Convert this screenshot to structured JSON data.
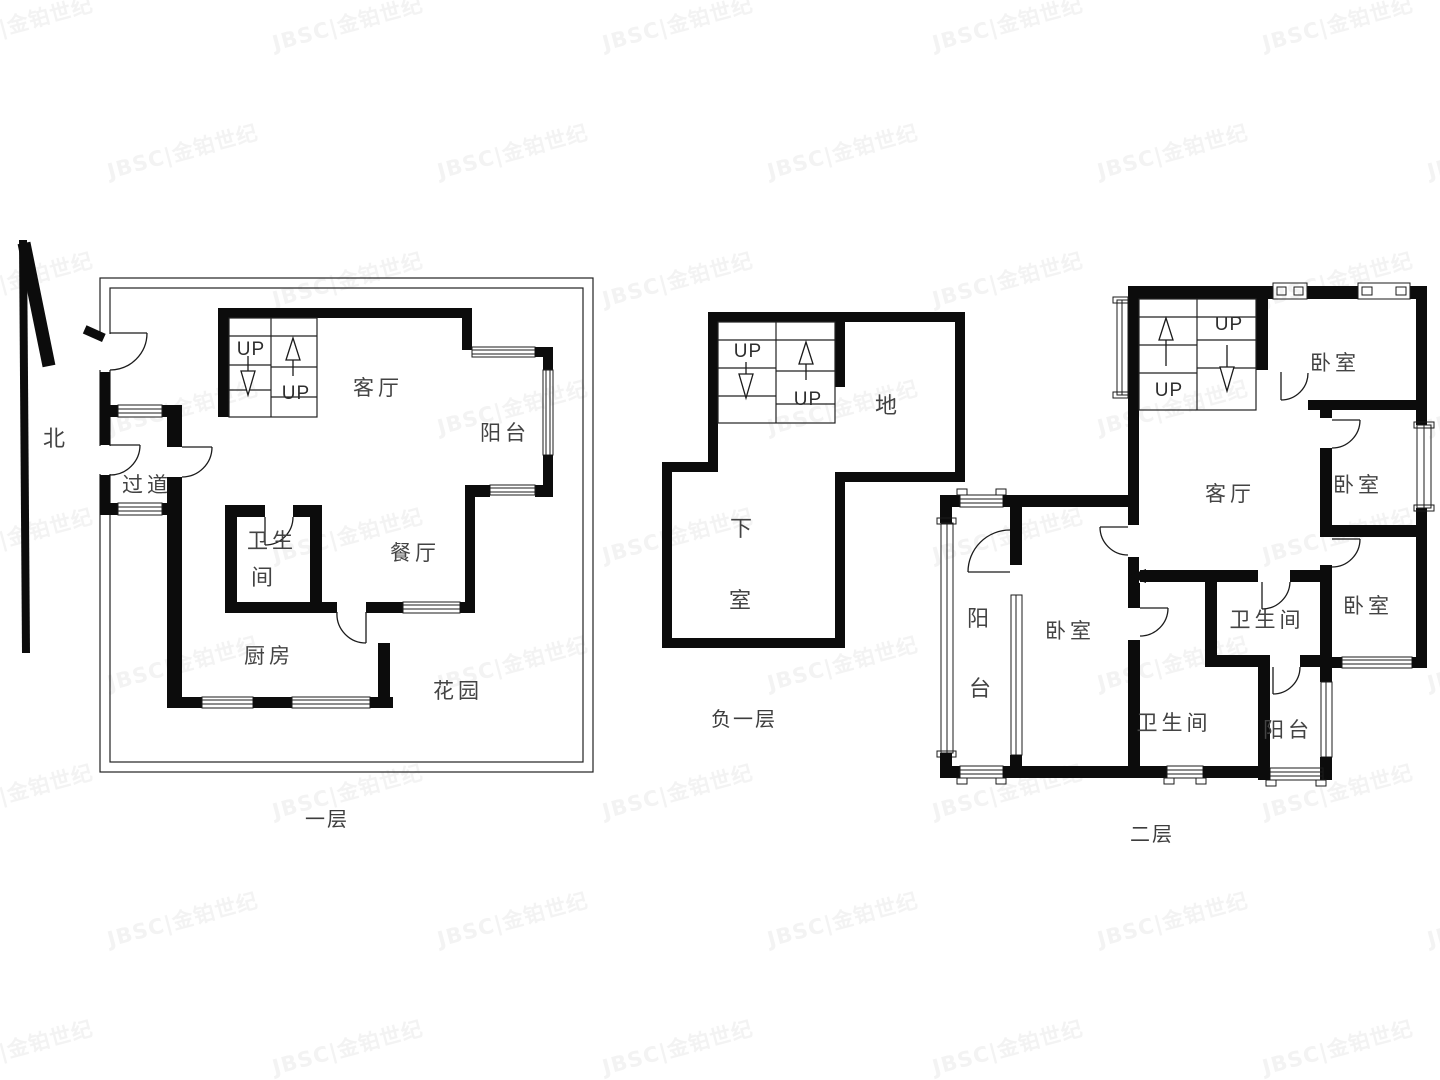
{
  "watermark": {
    "text": "JBSC|金铂世纪",
    "color": "#f3f3f3"
  },
  "north": {
    "label": "北"
  },
  "floors": {
    "floor1": {
      "label": "一层",
      "rooms": {
        "living": "客厅",
        "balcony": "阳台",
        "hallway": "过道",
        "bath_line1": "卫生",
        "bath_line2": "间",
        "dining": "餐厅",
        "kitchen": "厨房",
        "garden": "花园"
      },
      "stairs": {
        "up_left": "UP",
        "up_right": "UP"
      }
    },
    "basement": {
      "label": "负一层",
      "rooms": {
        "char1": "地",
        "char2": "下",
        "char3": "室"
      },
      "stairs": {
        "up_left": "UP",
        "up_right": "UP"
      }
    },
    "floor2": {
      "label": "二层",
      "rooms": {
        "living": "客厅",
        "bedroom_top": "卧室",
        "bedroom_mid": "卧室",
        "bedroom_bottom": "卧室",
        "bedroom_left": "卧室",
        "bath_center": "卫生间",
        "bath_left": "卫生间",
        "balcony_bottom": "阳台",
        "balcony_left_1": "阳",
        "balcony_left_2": "台"
      },
      "stairs": {
        "up_left": "UP",
        "up_right": "UP"
      }
    }
  }
}
